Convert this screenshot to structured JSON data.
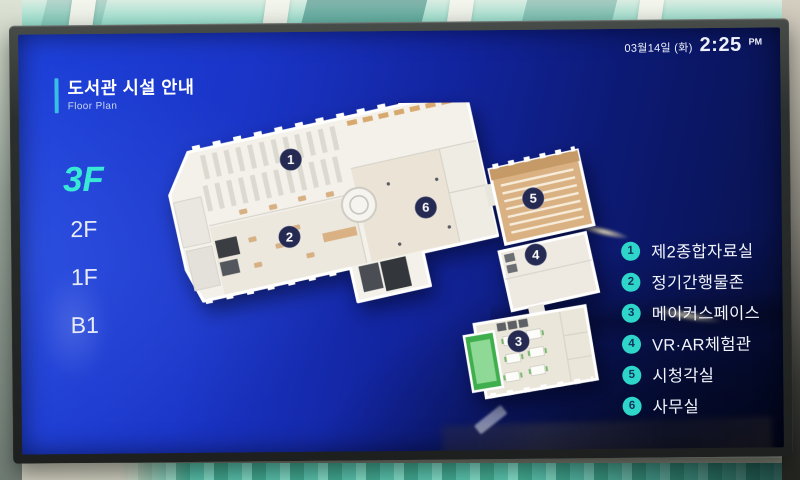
{
  "statusbar": {
    "date": "03월14일 (화)",
    "time": "2:25",
    "meridiem": "PM"
  },
  "header": {
    "title": "도서관 시설 안내",
    "subtitle": "Floor Plan"
  },
  "floor_nav": {
    "items": [
      {
        "label": "3F",
        "active": true
      },
      {
        "label": "2F",
        "active": false
      },
      {
        "label": "1F",
        "active": false
      },
      {
        "label": "B1",
        "active": false
      }
    ]
  },
  "floor_plan": {
    "markers": [
      {
        "number": "1"
      },
      {
        "number": "2"
      },
      {
        "number": "3"
      },
      {
        "number": "4"
      },
      {
        "number": "5"
      },
      {
        "number": "6"
      }
    ]
  },
  "legend": {
    "items": [
      {
        "number": "1",
        "label": "제2종합자료실"
      },
      {
        "number": "2",
        "label": "정기간행물존"
      },
      {
        "number": "3",
        "label": "메이커스페이스"
      },
      {
        "number": "4",
        "label": "VR·AR체험관"
      },
      {
        "number": "5",
        "label": "시청각실"
      },
      {
        "number": "6",
        "label": "사무실"
      }
    ]
  },
  "colors": {
    "accent_cyan": "#38bfe6",
    "active_floor": "#38e9d6",
    "legend_circle": "#2ed5c9",
    "marker_navy": "#252a52",
    "screen_blue": "#1a35c8"
  }
}
